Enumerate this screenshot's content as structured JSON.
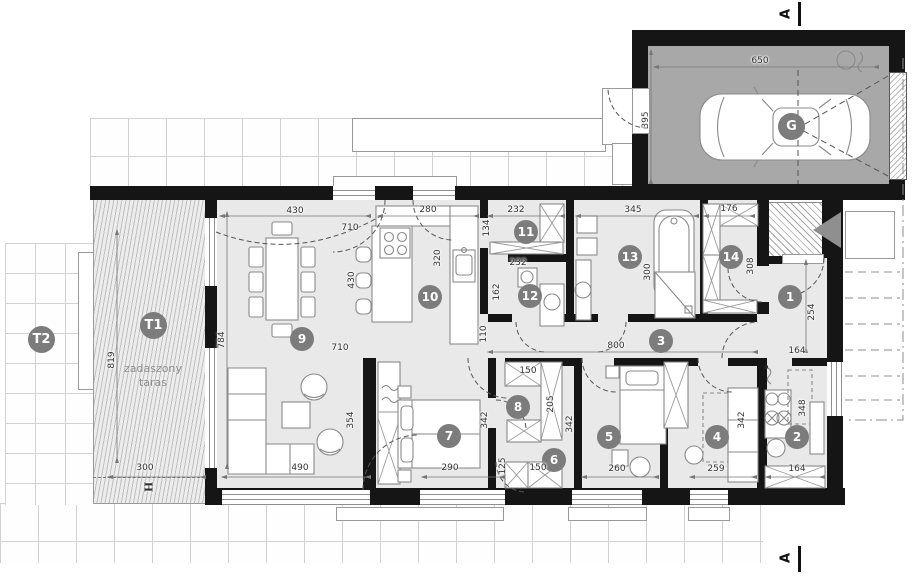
{
  "page": {
    "type": "architectural floor plan, ground floor with garage and terraces"
  },
  "markers": {
    "section": "A",
    "column": "H"
  },
  "labels": {
    "garage": "G",
    "terrace_covered": "T1",
    "terrace_caption_1": "zadaszony",
    "terrace_caption_2": "taras",
    "terrace_open": "T2"
  },
  "rooms": {
    "r1": "1",
    "r2": "2",
    "r3": "3",
    "r4": "4",
    "r5": "5",
    "r6": "6",
    "r7": "7",
    "r8": "8",
    "r9": "9",
    "r10": "10",
    "r11": "11",
    "r12": "12",
    "r13": "13",
    "r14": "14"
  },
  "dims": {
    "garage_width": "650",
    "garage_depth": "395",
    "dining_width": "430",
    "dining_door": "710",
    "kitchen_top": "280",
    "r11_width": "232",
    "r11_depth": "134",
    "r13_width": "345",
    "r13_tub": "300",
    "r14_width": "176",
    "r14_depth": "308",
    "counter_len": "320",
    "island_len": "430",
    "r12_width": "232",
    "r12_depth": "162",
    "living_left": "784",
    "living_width_mid": "710",
    "corridor_len": "800",
    "corridor_w": "110",
    "t1_depth": "819",
    "t1_width": "300",
    "lounge_depth": "354",
    "lounge_width": "490",
    "r7_width": "290",
    "r7_depth": "342",
    "r8_top": "150",
    "r8_depth": "205",
    "r8_right": "342",
    "r6_left": "125",
    "r6_width": "150",
    "r5_width": "260",
    "r4_width": "259",
    "r4_depth": "342",
    "r2_depth": "348",
    "r2_width": "164",
    "r1_depth": "254",
    "r1_width": "164"
  }
}
